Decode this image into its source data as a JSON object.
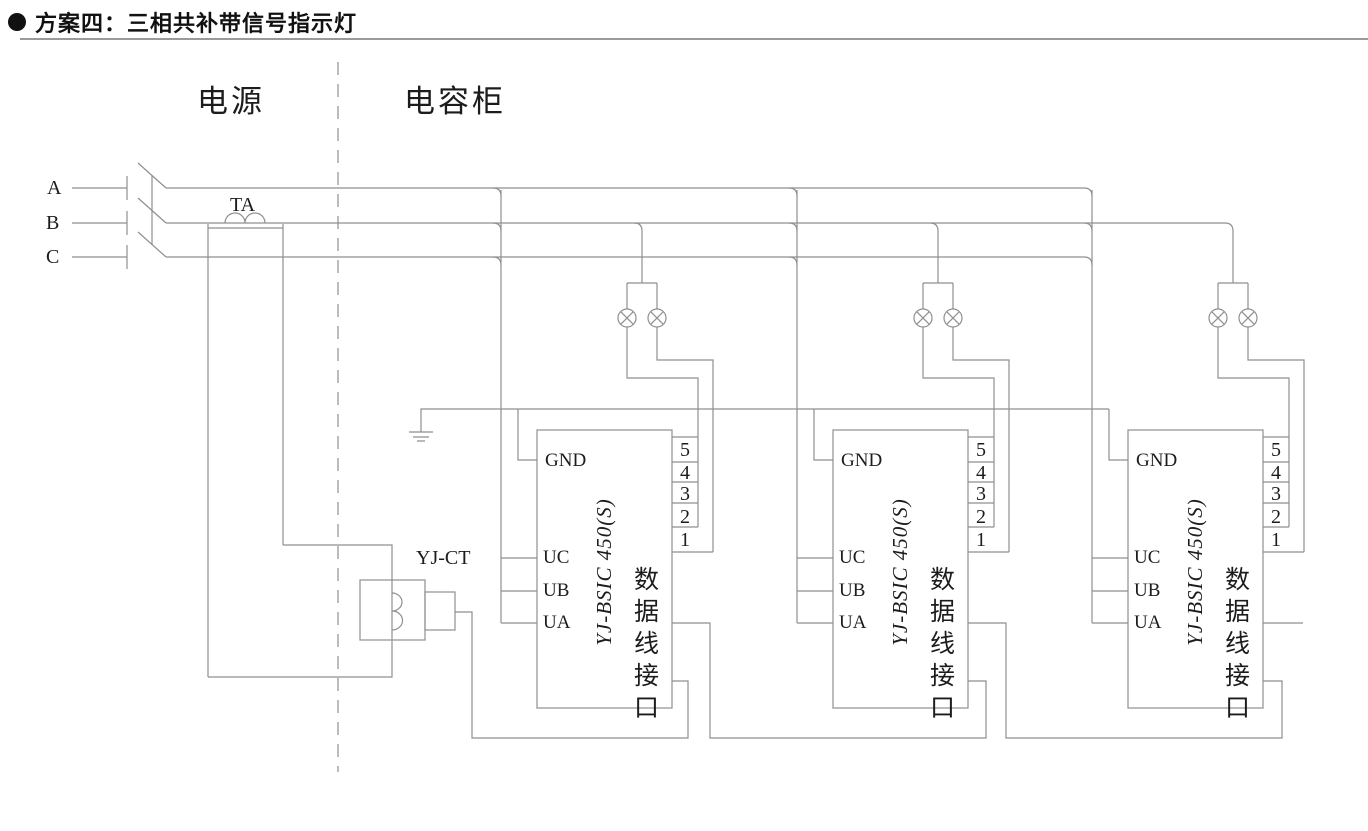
{
  "header": {
    "title": "方案四：三相共补带信号指示灯"
  },
  "zones": {
    "power": "电源",
    "capacitor": "电容柜"
  },
  "phases": {
    "a": "A",
    "b": "B",
    "c": "C"
  },
  "transformer": {
    "ta_label": "TA",
    "yjct_label": "YJ-CT"
  },
  "unit": {
    "model": "YJ-BSIC 450(S)",
    "port_label": "数据线接口",
    "pins": {
      "gnd": "GND",
      "uc": "UC",
      "ub": "UB",
      "ua": "UA"
    },
    "terminals": [
      "5",
      "4",
      "3",
      "2",
      "1"
    ]
  },
  "symbols": {
    "lamp": "indicator-lamp",
    "ground": "earth-ground",
    "breaker": "three-pole-switch"
  },
  "colors": {
    "line": "#8f8f8f",
    "text": "#1c1c1c",
    "title": "#111111"
  }
}
